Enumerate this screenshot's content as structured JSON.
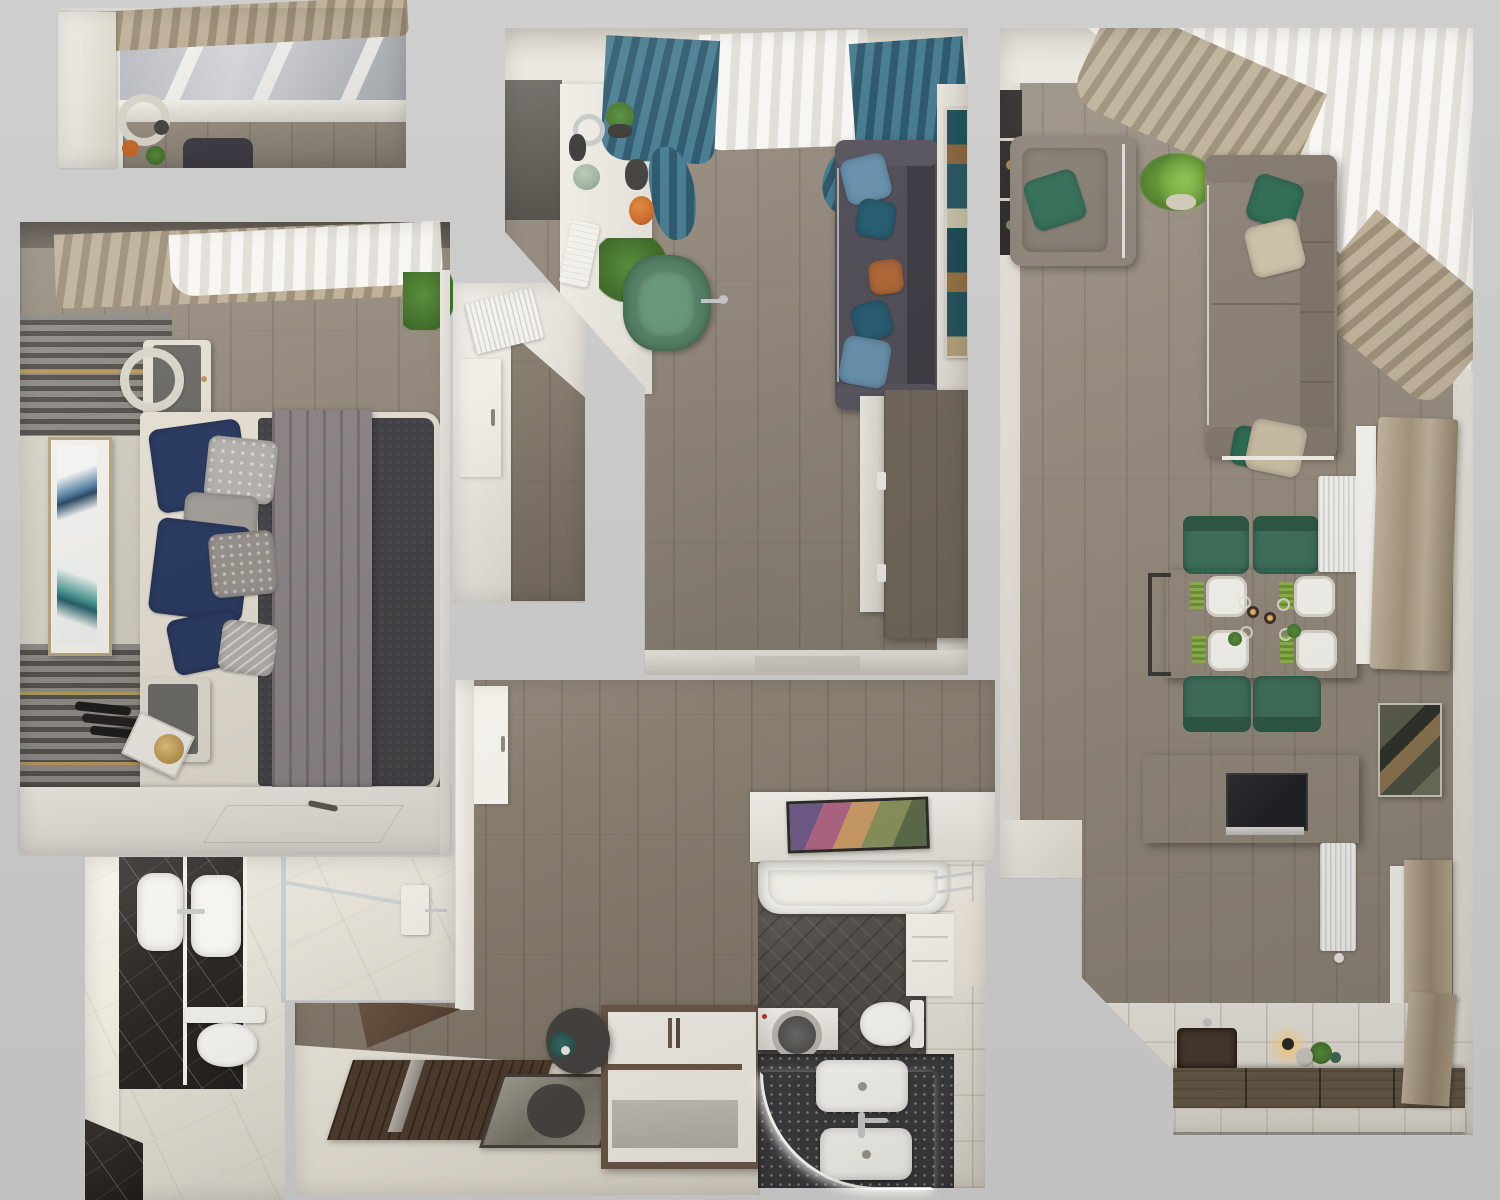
{
  "scene": {
    "title": "apartment-top-down-3d-floor-plan-render",
    "view": "top-down orthographic 3D render, photoreal, no visible text",
    "rooms": [
      {
        "name": "balcony",
        "furniture": [
          "awning",
          "window-frames",
          "decor-shelf",
          "sofa-corner"
        ]
      },
      {
        "name": "bedroom",
        "furniture": [
          "sheer-curtain",
          "beige-curtain",
          "slat-accent-wall",
          "double-artwork",
          "nightstand-with-lamp",
          "double-bed",
          "navy-pillows",
          "gray-blanket",
          "nightstand-with-tray",
          "wardrobe",
          "plant"
        ]
      },
      {
        "name": "bathroom-main",
        "furniture": [
          "black-marble-vanity",
          "twin-sinks",
          "toilet",
          "glass-shower",
          "white-marble-floor"
        ]
      },
      {
        "name": "inner-hall",
        "furniture": [
          "radiator",
          "door",
          "wood-floor"
        ]
      },
      {
        "name": "study-lounge",
        "furniture": [
          "teal-curtains",
          "sheer-curtain",
          "shelf-desk",
          "plants",
          "orange-vase",
          "keyboard",
          "green-desk-chair",
          "dark-sofa",
          "blue-teal-orange-pillows",
          "tall-artwork",
          "wood-dresser"
        ]
      },
      {
        "name": "hallway-entry",
        "furniture": [
          "door",
          "console-desk",
          "colorful-painting",
          "entry-door-mat",
          "floor-mirror",
          "pouf",
          "shoe-cabinet",
          "wood-shelf"
        ]
      },
      {
        "name": "bathroom-second",
        "furniture": [
          "bathtub",
          "toilet",
          "washing-machine",
          "speckled-counter",
          "twin-sinks",
          "led-light-arc",
          "beige-tile-wall"
        ]
      },
      {
        "name": "living-dining-kitchen",
        "furniture": [
          "corner-curtains",
          "black-shelf",
          "armchair",
          "palm-plant",
          "gray-sofa",
          "green-beige-pillows",
          "dining-table",
          "four-green-chairs",
          "plates-setting",
          "radiators",
          "curtained-windows",
          "abstract-artworks",
          "marble-tv-console",
          "tv",
          "kitchen-sink",
          "wall-lamp",
          "upper-cabinets",
          "marble-tile-floor"
        ]
      }
    ]
  },
  "palette": {
    "bg": "#c9c9c9",
    "bg-light": "#cfcfcf",
    "bg-dark": "#c1c1c1",
    "wall": "#eae7e0",
    "wall-dim": "#d9d5cc",
    "wall-dark": "#696560",
    "wood-a": "#9a9083",
    "wood-b": "#8b8174",
    "wood-hall-a": "#8a8072",
    "wood-hall-b": "#7c7264",
    "door-wood": "#5c4737",
    "mat-wood": "#4e3c2d",
    "slat-light": "#8f8c88",
    "slat-dark": "#57534f",
    "gold": "#b79b5e",
    "sheer-a": "#f7f6f3",
    "sheer-b": "#e2dfd8",
    "teal-a": "#4a7d92",
    "teal-b": "#2f5a6e",
    "beige-a": "#bfb19a",
    "beige-b": "#9d8f78",
    "taupe-a": "#c2b49e",
    "taupe-b": "#978871",
    "sofa-a": "#54515a",
    "sofa-b": "#413e47",
    "pillow-blue": "#6b94b0",
    "pillow-teal": "#2a5f74",
    "pillow-orange": "#b26a3a",
    "chair-green": "#578468",
    "pillow-green": "#2f6b53",
    "sofa-gray-a": "#8d postgraduate",
    "sofa-gray": "#8b8177",
    "sofa-gray-dark": "#7d7368",
    "bed-frame": "#e5dfd3",
    "mattress": "#454549",
    "blanket": "#8e8688",
    "pillow-navy": "#2c3c63",
    "pillow-gray": "#a5a09b",
    "marble-w": "#eae6dd",
    "marble-b": "#2b2724",
    "tile-dark": "#55504b",
    "tile-beige": "#d6cdc0",
    "counter-speck": "#3b3a3d",
    "table-wood-a": "#7d6d5d",
    "table-wood-b": "#6f6050",
    "chair-dgreen": "#3f6f5b",
    "chair-dgreen-dark": "#2f5746",
    "tv": "#222226",
    "cab-a": "#6b5c4c",
    "cab-b": "#3a3128",
    "white": "#f2f1ed",
    "cream": "#e9e6df",
    "plant-a": "#5a8f3c",
    "plant-b": "#3f6b2a",
    "chrome": "#c6c8c9",
    "orange-decor": "#c96a2e",
    "sage": "#9eb3a0",
    "led": "#fdfdf8",
    "glow": "#ffd893"
  }
}
